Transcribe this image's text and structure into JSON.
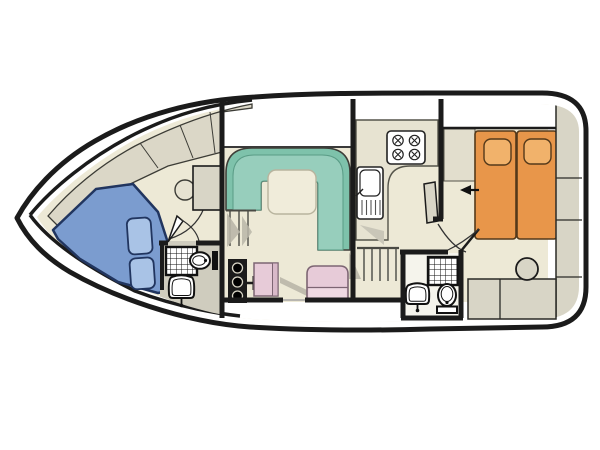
{
  "diagram": {
    "type": "boat-deck-floor-plan",
    "orientation_bow": "left",
    "rooms": [
      {
        "name": "v-berth-cabin"
      },
      {
        "name": "forward-bathroom"
      },
      {
        "name": "saloon-dinette"
      },
      {
        "name": "galley"
      },
      {
        "name": "helm-area"
      },
      {
        "name": "aft-cabin"
      },
      {
        "name": "aft-bathroom"
      },
      {
        "name": "side-deck-walkways"
      }
    ],
    "fixtures": [
      "v-berth-blue-mattress",
      "berth-cushions",
      "forward-wardrobe",
      "forward-shower",
      "forward-toilet",
      "forward-washbasin",
      "u-shaped-dinette-bench",
      "dinette-table",
      "galley-sink-drainer",
      "stove-four-burner",
      "helm-console-knobs",
      "throttle-lever",
      "helm-seat",
      "bench-seat",
      "companionway-steps-forward",
      "companionway-steps-aft",
      "double-bed",
      "bed-pillows",
      "aft-wardrobe",
      "stern-cabinets",
      "stool",
      "aft-shower",
      "aft-toilet",
      "aft-washbasin",
      "direction-arrow"
    ]
  },
  "colors": {
    "background": "#ffffff",
    "hull_line": "#1b1b1b",
    "deck_white": "#ffffff",
    "floor": "#EDE9D6",
    "foredeck": "#DBD7C7",
    "cabinet_gray": "#D8D5C6",
    "bathroom_floor": "#CFCCBE",
    "aft_bath_floor": "#F5F4EC",
    "berth_blue": "#7B9CCF",
    "berth_cushion": "#A9C3E6",
    "berth_outline": "#21355F",
    "dinette_outer": "#7EC2AB",
    "dinette_seat": "#97CEBC",
    "table": "#F0ECDA",
    "bed_orange": "#E8964A",
    "pillow_orange": "#F1B26B",
    "bed_outline": "#54391A",
    "seat_pink": "#E7CBD8",
    "seat_pink_light": "#EFD9E2",
    "seat_pink_outline": "#7D6573",
    "wardrobe_fill": "#E2DECD",
    "wall": "#1b1b1b",
    "shadow": "#B9B6A8",
    "step_line": "#4A4A44",
    "fixture_outline": "#111111",
    "fixture_fill": "#ffffff"
  }
}
